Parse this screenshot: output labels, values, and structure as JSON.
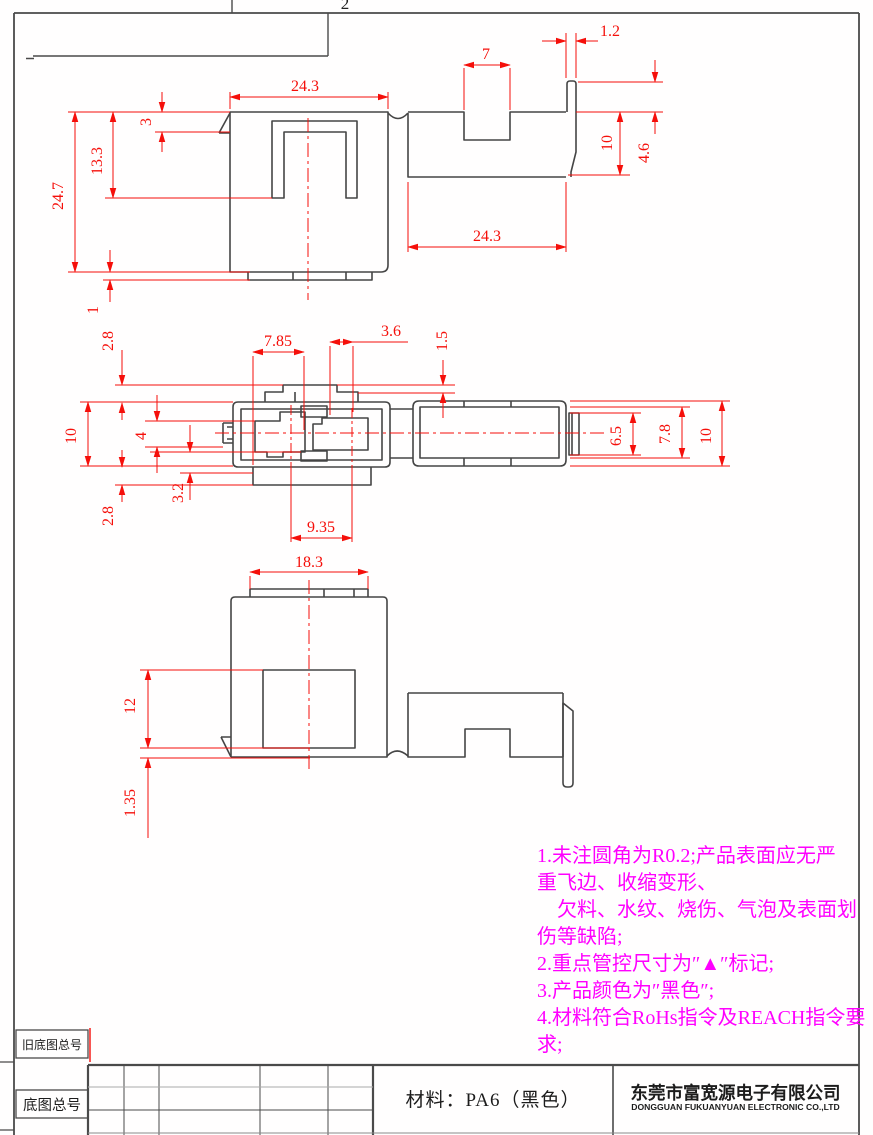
{
  "sheet": {
    "zone": "2"
  },
  "dims": {
    "top": {
      "body_w": "24.3",
      "notch": "7",
      "strip": "1.2",
      "slot": "3",
      "inner": "13.3",
      "height": "24.7",
      "arm": "10",
      "hook": "4.6",
      "arm_w": "24.3",
      "foot": "1"
    },
    "mid": {
      "t1": "2.8",
      "p": "7.85",
      "g": "3.6",
      "lip": "1.5",
      "h": "10",
      "cav": "4",
      "skirt": "3.2",
      "b1": "2.8",
      "pitch": "9.35",
      "c1": "6.5",
      "c2": "7.8",
      "c3": "10"
    },
    "bot": {
      "tab": "18.3",
      "win": "12",
      "gap": "1.35"
    }
  },
  "notes": {
    "lines": [
      "1.未注圆角为R0.2;产品表面应无严",
      "重飞边、收缩变形、",
      "　欠料、水纹、烧伤、气泡及表面划",
      "伤等缺陷;",
      "2.重点管控尺寸为″▲″标记;",
      "3.产品颜色为″黑色″;",
      "4.材料符合RoHs指令及REACH指令要",
      "求;"
    ]
  },
  "title_block": {
    "old_no": "旧底图总号",
    "no": "底图总号",
    "material": "材料：PA6（黑色）",
    "company_cn": "东莞市富宽源电子有限公司",
    "company_en": "DONGGUAN FUKUANYUAN ELECTRONIC CO.,LTD"
  }
}
